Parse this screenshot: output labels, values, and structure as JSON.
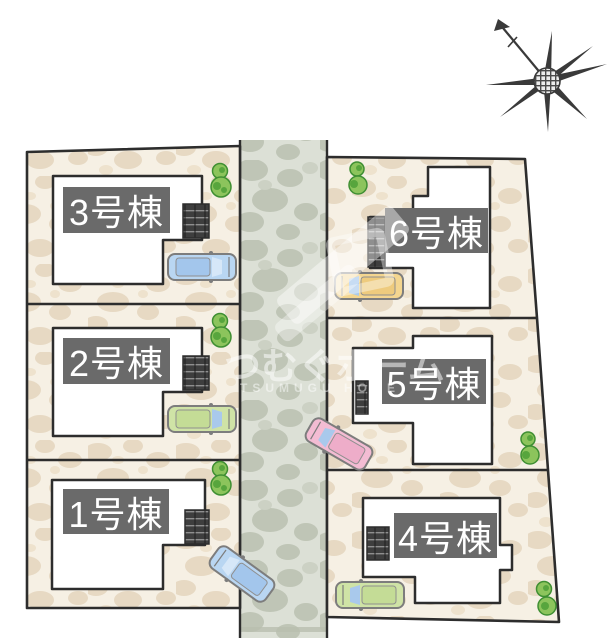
{
  "site_plan": {
    "buildings": [
      {
        "id": 1,
        "label": "1号棟"
      },
      {
        "id": 2,
        "label": "2号棟"
      },
      {
        "id": 3,
        "label": "3号棟"
      },
      {
        "id": 4,
        "label": "4号棟"
      },
      {
        "id": 5,
        "label": "5号棟"
      },
      {
        "id": 6,
        "label": "6号棟"
      }
    ],
    "label_style": {
      "bg": "#6a6a6a",
      "text": "#ffffff"
    },
    "parcel_color": "#f6f0e4",
    "road_color": "#dce0d6",
    "house_fill": "#ffffff",
    "outline_color": "#2d2d2d",
    "tree_color": "#8cc45c",
    "cars": [
      {
        "lot": "3号棟",
        "body": "#b9d6f2",
        "roof": "#a3c6ec",
        "windshield": "#d6e7f8"
      },
      {
        "lot": "2号棟",
        "body": "#cfe3a6",
        "roof": "#c4dc96",
        "windshield": "#a9c9ec"
      },
      {
        "lot": "1号棟",
        "body": "#b9d6f2",
        "roof": "#a3c6ec",
        "windshield": "#d6e7f8"
      },
      {
        "lot": "6号棟",
        "body": "#f4d690",
        "roof": "#eecb7e",
        "windshield": "#a9c9ec"
      },
      {
        "lot": "5号棟",
        "body": "#f3bcd3",
        "roof": "#eeadc9",
        "windshield": "#a9c9ec"
      },
      {
        "lot": "4号棟",
        "body": "#cfe3a6",
        "roof": "#c4dc96",
        "windshield": "#a9c9ec"
      }
    ],
    "watermark": {
      "kana": "つむぐホーム",
      "latin": "TSUMUGU HOME"
    },
    "compass": {
      "type": "north-arrow"
    }
  }
}
